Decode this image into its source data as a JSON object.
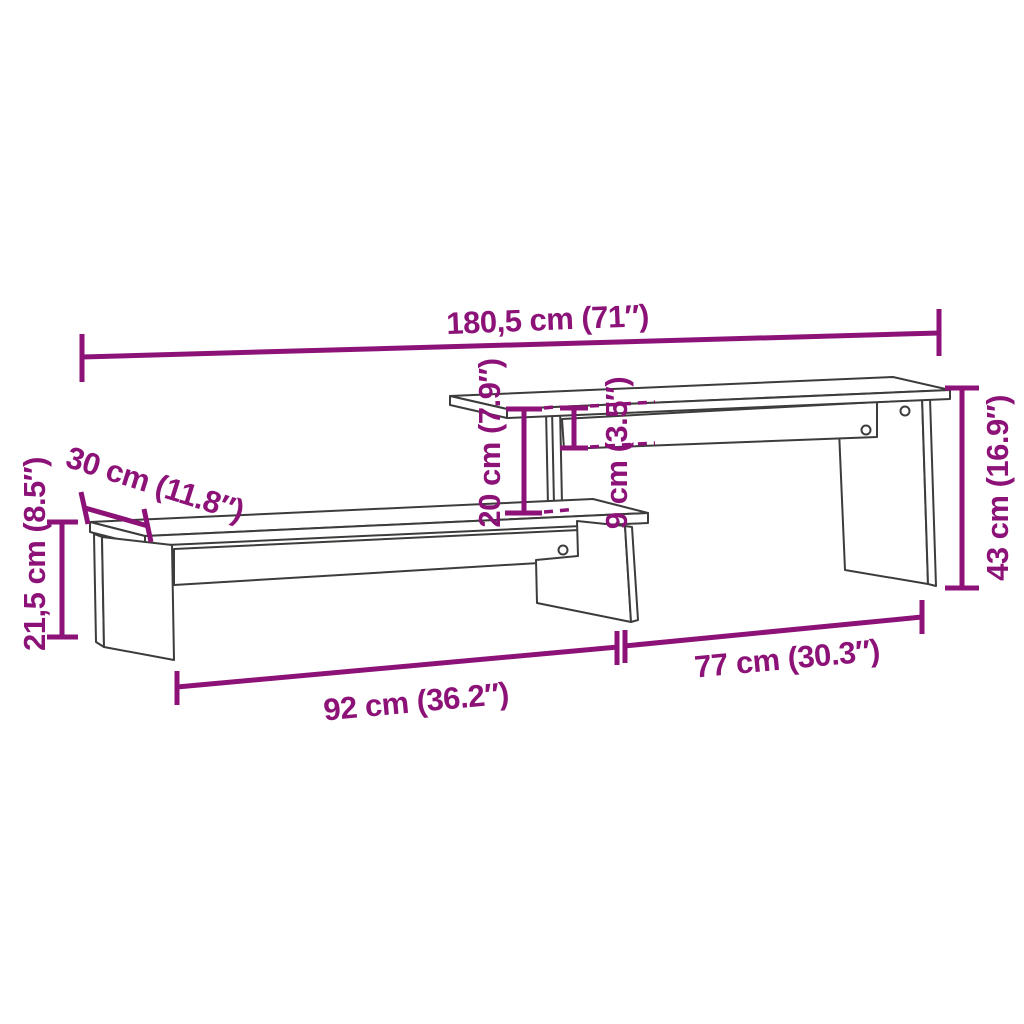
{
  "colors": {
    "background": "#FFFFFF",
    "outline": "#3C3C3B",
    "dimension": "#8C1278"
  },
  "diagram": {
    "type": "furniture-dimension-line-drawing",
    "subject": "two-tier tv-stand",
    "labels": {
      "total_width": "180,5 cm (71″)",
      "depth": "30 cm (11.8″)",
      "left_height": "21,5 cm (8.5″)",
      "shelf_gap": "20 cm (7.9″)",
      "top_section_height": "9 cm (3.5″)",
      "right_height": "43 cm (16.9″)",
      "lower_section_width": "92 cm (36.2″)",
      "upper_section_width": "77 cm (30.3″)"
    }
  }
}
